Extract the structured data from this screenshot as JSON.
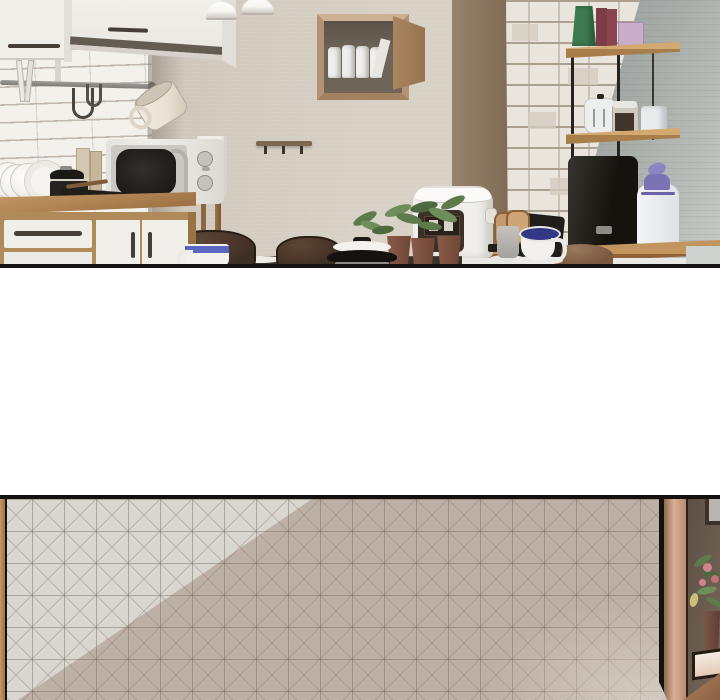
{
  "meta": {
    "width": 720,
    "height": 700,
    "kind": "webtoon-scene-strip",
    "panel_count": 2,
    "text_content": "none"
  },
  "scene": {
    "panels": [
      {
        "name": "kitchen-interior",
        "objects": [
          "upper-cabinets",
          "pendant-lamps",
          "subway-tile-backsplash",
          "hanging-rail",
          "s-hooks",
          "hanging-mug",
          "wall-box-shelf",
          "storage-jars",
          "wall-hook-rail",
          "console-table",
          "microwave",
          "cutting-boards",
          "dish-rack",
          "plates",
          "stock-pot",
          "grill-pan",
          "wood-counter",
          "lower-cabinets",
          "drawer",
          "cabinet-doors",
          "brick-column",
          "wall-shelf-unit",
          "books",
          "lilac-box",
          "kettle-jar",
          "glass-jar",
          "paper-roll",
          "water-purifier",
          "water-jug-purple-lid",
          "rice-cooker",
          "potted-plants",
          "coaster-stand",
          "black-tray",
          "gray-cup",
          "navy-mug",
          "dining-table",
          "dining-chairs",
          "blue-stripe-mug",
          "lidded-pot",
          "right-counter",
          "person-head"
        ]
      },
      {
        "name": "tiled-wall-with-doorway",
        "objects": [
          "grid-tile-wall",
          "diagonal-light",
          "wood-door-frame",
          "picture-frame",
          "flower-plant",
          "plant-pot",
          "cream-ledge"
        ]
      }
    ]
  },
  "palette": {
    "ink": "#141110",
    "white": "#ffffff",
    "beige-wall-1": "#cdc5b9",
    "beige-wall-2": "#d8d1c6",
    "tile-white": "#f3f1ec",
    "shadow-band": "rgba(120,112,101,.5)",
    "brown-band-1": "#95836c",
    "brown-band-2": "#7e6b55",
    "gray-wall-1": "#8f9795",
    "gray-wall-2": "#c6cac7",
    "brick-face": "#e9e4dc",
    "brick-mortar": "#ab9f90",
    "brick-dark": "#d4ccc0",
    "cabinet-white": "#f0eee9",
    "cabinet-shade": "#e2dfd8",
    "handle-dark": "#453f38",
    "rail-gray": "#8f8c87",
    "mug-cream": "#e9e2d5",
    "wood-light": "#c59a66",
    "wood-mid": "#b08a58",
    "wood-dark": "#916336",
    "counter-front": "#8f6135",
    "lamp-white": "#f8f6f2",
    "lamp-edge": "#cfcac3",
    "box-frame": "#b59273",
    "box-interior": "#6e6458",
    "box-side": "#9c7a55",
    "jar-white": "#eff0ee",
    "hook-wood": "#7c6750",
    "hook-dark": "#3a332b",
    "shelf-wood-top": "#d3a871",
    "shelf-wood-front": "#a87f4b",
    "frame-black": "#262220",
    "book-green": "#3e7a50",
    "book-maroon": "#7c3c48",
    "book-maroon2": "#8a4452",
    "box-lilac": "#c9aec9",
    "teapot-white": "#edefee",
    "jar-glass": "#cfc9c0",
    "beans-dark": "#41342a",
    "roll-white": "#e9ebec",
    "appliance-black-1": "#383430",
    "appliance-black-2": "#16130f",
    "jug-white": "#f2f4f6",
    "jug-purple": "#7c73b5",
    "jug-purple2": "#8d84c4",
    "cooker-white": "#f0eeea",
    "cooker-panel": "#3c3127",
    "plant-green-1": "#5d7a4b",
    "plant-green-2": "#6f8d5a",
    "plant-green-3": "#4c6a3e",
    "pot-terracotta-1": "#8a5c49",
    "pot-terracotta-2": "#6e4636",
    "coaster-wood": "#c59a6c",
    "tray-black": "#211d1a",
    "cup-gray-1": "#c6c2be",
    "cup-gray-2": "#a5a19d",
    "mug-navy": "#333a85",
    "mug-blue": "#5a66c0",
    "chair-brown-1": "#5d4536",
    "chair-brown-2": "#3f2e23",
    "table-dark": "#3a322b",
    "head-brown-1": "#9b7a5e",
    "head-brown-2": "#7a573f",
    "mw-body-1": "#e5e2dd",
    "mw-body-2": "#f0eee9",
    "mw-door": "#cbc8c3",
    "mw-window-1": "#332f2b",
    "mw-window-2": "#1e1b18",
    "mw-silver": "#b5b1ab",
    "pot-black": "#262220",
    "pan-black": "#211d1a",
    "board-tan": "#d4c8b2",
    "board-tan2": "#c6b69c",
    "plate-white": "#f6f4f0",
    "gray-panel": "#ced2cf",
    "pb-tile": "#d9d6d0",
    "pb-line": "rgba(121,106,93,.45)",
    "pb-xline": "rgba(121,106,93,.30)",
    "pb-shadow": "rgba(134,99,83,.33)",
    "pb-corner": "rgba(234,229,221,.5)",
    "door-wood-1": "#8d6a52",
    "door-wood-2": "#d9ae93",
    "door-wood-3": "#b98d72",
    "door-interior-1": "#5d4f45",
    "door-interior-2": "#776759",
    "pic-frame": "#b9b6b2",
    "pic-border": "#3c3028",
    "flower-pink": "#d3838e",
    "flower-pink2": "#c2707e",
    "leaf-yellow": "#c9c075",
    "ledge-cream-1": "#f6ece2",
    "ledge-cream-2": "#e2cab9",
    "door-pot": "#7d564a",
    "sliver-wood": "#c29a6a"
  }
}
